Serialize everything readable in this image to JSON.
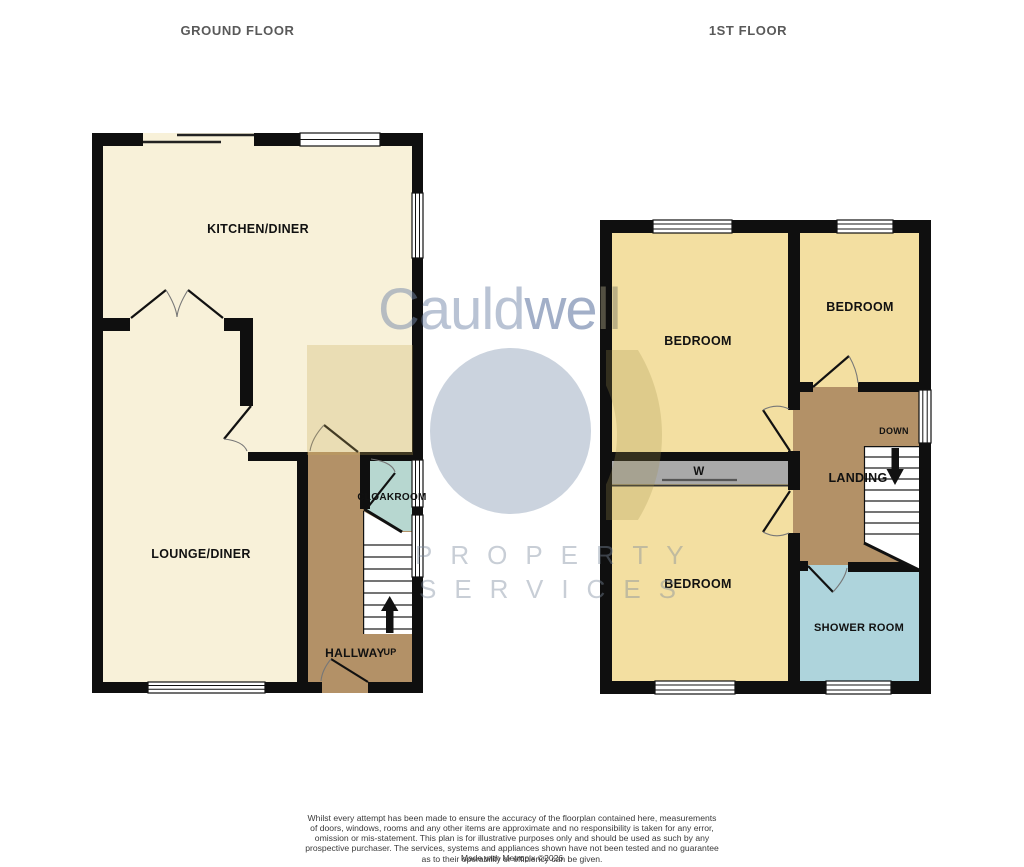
{
  "titles": {
    "ground": "GROUND FLOOR",
    "first": "1ST FLOOR"
  },
  "ground_floor": {
    "rooms": {
      "kitchen_diner": "KITCHEN/DINER",
      "lounge_diner": "LOUNGE/DINER",
      "cloakroom": "CLOAKROOM",
      "hallway": "HALLWAY"
    },
    "stairs_label": "UP"
  },
  "first_floor": {
    "rooms": {
      "bedroom_top_left": "BEDROOM",
      "bedroom_top_right": "BEDROOM",
      "bedroom_bottom": "BEDROOM",
      "landing": "LANDING",
      "shower_room": "SHOWER ROOM",
      "wardrobe": "W"
    },
    "stairs_label": "DOWN"
  },
  "watermark": {
    "brand_parts": [
      "Cauld",
      "we",
      "ll"
    ],
    "line1": "PROPERTY",
    "line2": "SERVICES"
  },
  "disclaimer": {
    "text": "Whilst every attempt has been made to ensure the accuracy of the floorplan contained here, measurements\nof doors, windows, rooms and any other items are approximate and no responsibility is taken for any error,\nomission or mis-statement. This plan is for illustrative purposes only and should be used as such by any\nprospective purchaser. The services, systems and appliances shown have not been tested and no guarantee\nas to their operability or efficiency can be given.",
    "made_with": "Made with Metropix ©2026"
  },
  "colors": {
    "room_cream": "#f8f1d9",
    "room_yellow": "#f3dfa1",
    "hall_brown": "#b39167",
    "cloakroom_teal": "#b7d7d0",
    "shower_blue": "#aed4dc",
    "wardrobe_gray": "#a9a9a9",
    "wall": "#0f0f0f",
    "watermark_blue": "#cbd3de"
  }
}
